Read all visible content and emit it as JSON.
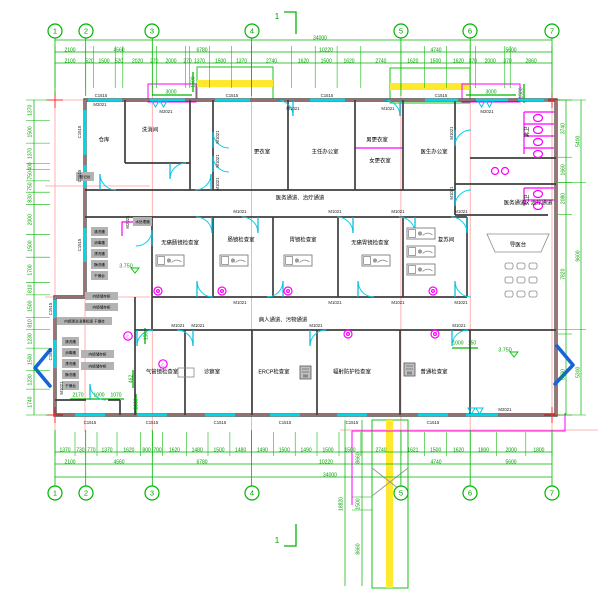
{
  "colors": {
    "dimension": "#00b400",
    "axis": "#ff9c9c",
    "wall": "#4f4f4f",
    "window": "#00d8e8",
    "magenta": "#ff00ff",
    "stair": "#ffef3d",
    "arrow": "#1565d8"
  },
  "grid_bubbles": {
    "top_y": 31,
    "bottom_y": 493,
    "top": [
      {
        "t": "1",
        "x": 55
      },
      {
        "t": "2",
        "x": 86
      },
      {
        "t": "3",
        "x": 152
      },
      {
        "t": "4",
        "x": 252
      },
      {
        "t": "5",
        "x": 401
      },
      {
        "t": "6",
        "x": 470
      },
      {
        "t": "7",
        "x": 552
      }
    ],
    "bottom": [
      {
        "t": "1",
        "x": 55
      },
      {
        "t": "2",
        "x": 86
      },
      {
        "t": "3",
        "x": 152
      },
      {
        "t": "4",
        "x": 252
      },
      {
        "t": "5",
        "x": 401
      },
      {
        "t": "6",
        "x": 470
      },
      {
        "t": "7",
        "x": 552
      }
    ]
  },
  "boundaries": {
    "grid_x": [
      55,
      85.7,
      152.3,
      251.5,
      400.9,
      470.2,
      552
    ],
    "top_x": [
      55,
      85.7,
      93.3,
      115.2,
      122.8,
      152.3,
      156.3,
      185.5,
      189.5,
      209.5,
      231.4,
      251.5,
      291.5,
      315.2,
      337.1,
      360.8,
      400.9,
      424.6,
      446.5,
      470.2,
      475.6,
      504.8,
      510.2,
      552
    ],
    "bottom_x": [
      55,
      75,
      85.7,
      97,
      117,
      140.7,
      152.4,
      162.6,
      186.3,
      208,
      229.9,
      251.5,
      273.3,
      295.2,
      317,
      339,
      360.9,
      401,
      424.7,
      446.6,
      470.3,
      496.6,
      525.8,
      552
    ],
    "left_y": [
      100,
      120.6,
      143.1,
      163.6,
      169.6,
      180.9,
      192.2,
      204.7,
      234.7,
      257.2,
      282.7,
      294.9,
      317.4,
      329.6,
      348.1,
      370.6,
      389.1,
      415
    ],
    "right_inner_y": [
      100,
      157.2,
      182.6,
      214.4,
      334,
      415
    ],
    "right_outer_y": [
      100,
      182.6,
      329.4,
      415
    ]
  },
  "labels": {
    "dims": [
      {
        "t": "34000",
        "x": 320,
        "y": 38
      },
      {
        "t": "2100",
        "x": 70,
        "y": 50
      },
      {
        "t": "4560",
        "x": 119,
        "y": 50
      },
      {
        "t": "6780",
        "x": 202,
        "y": 50
      },
      {
        "t": "10220",
        "x": 326,
        "y": 50
      },
      {
        "t": "4740",
        "x": 436,
        "y": 50
      },
      {
        "t": "5600",
        "x": 511,
        "y": 50
      },
      {
        "t": "2100",
        "x": 70,
        "y": 61
      },
      {
        "t": "520",
        "x": 89.5,
        "y": 61
      },
      {
        "t": "1500",
        "x": 104,
        "y": 61
      },
      {
        "t": "520",
        "x": 119,
        "y": 61
      },
      {
        "t": "2020",
        "x": 137.6,
        "y": 61
      },
      {
        "t": "270",
        "x": 154.3,
        "y": 61
      },
      {
        "t": "2000",
        "x": 171,
        "y": 61
      },
      {
        "t": "270",
        "x": 187.5,
        "y": 61
      },
      {
        "t": "1370",
        "x": 199.5,
        "y": 61
      },
      {
        "t": "1500",
        "x": 220.5,
        "y": 61
      },
      {
        "t": "1370",
        "x": 241.5,
        "y": 61
      },
      {
        "t": "2740",
        "x": 271.5,
        "y": 61
      },
      {
        "t": "1620",
        "x": 303.4,
        "y": 61
      },
      {
        "t": "1500",
        "x": 326.2,
        "y": 61
      },
      {
        "t": "1620",
        "x": 349,
        "y": 61
      },
      {
        "t": "2740",
        "x": 380.9,
        "y": 61
      },
      {
        "t": "1620",
        "x": 412.8,
        "y": 61
      },
      {
        "t": "1500",
        "x": 435.6,
        "y": 61
      },
      {
        "t": "1620",
        "x": 458.4,
        "y": 61
      },
      {
        "t": "370",
        "x": 472.9,
        "y": 61
      },
      {
        "t": "2000",
        "x": 490.2,
        "y": 61
      },
      {
        "t": "370",
        "x": 507.5,
        "y": 61
      },
      {
        "t": "2860",
        "x": 531.1,
        "y": 61
      },
      {
        "t": "1370",
        "x": 65,
        "y": 450
      },
      {
        "t": "730",
        "x": 80.4,
        "y": 450
      },
      {
        "t": "770",
        "x": 91.4,
        "y": 450
      },
      {
        "t": "1370",
        "x": 107,
        "y": 450
      },
      {
        "t": "1620",
        "x": 128.9,
        "y": 450
      },
      {
        "t": "800",
        "x": 146.6,
        "y": 450
      },
      {
        "t": "700",
        "x": 157.5,
        "y": 450
      },
      {
        "t": "1620",
        "x": 174.5,
        "y": 450
      },
      {
        "t": "1480",
        "x": 197.2,
        "y": 450
      },
      {
        "t": "1500",
        "x": 219,
        "y": 450
      },
      {
        "t": "1480",
        "x": 240.7,
        "y": 450
      },
      {
        "t": "1490",
        "x": 262.4,
        "y": 450
      },
      {
        "t": "1500",
        "x": 284.3,
        "y": 450
      },
      {
        "t": "1490",
        "x": 306.1,
        "y": 450
      },
      {
        "t": "1500",
        "x": 328,
        "y": 450
      },
      {
        "t": "1500",
        "x": 350,
        "y": 450
      },
      {
        "t": "2740",
        "x": 381,
        "y": 450
      },
      {
        "t": "1621",
        "x": 412.9,
        "y": 450
      },
      {
        "t": "1500",
        "x": 435.7,
        "y": 450
      },
      {
        "t": "1620",
        "x": 458.5,
        "y": 450
      },
      {
        "t": "1800",
        "x": 483.5,
        "y": 450
      },
      {
        "t": "2000",
        "x": 511.2,
        "y": 450
      },
      {
        "t": "1800",
        "x": 538.9,
        "y": 450
      },
      {
        "t": "2100",
        "x": 70,
        "y": 462
      },
      {
        "t": "4560",
        "x": 119,
        "y": 462
      },
      {
        "t": "6780",
        "x": 202,
        "y": 462
      },
      {
        "t": "10220",
        "x": 326,
        "y": 462
      },
      {
        "t": "4740",
        "x": 436,
        "y": 462
      },
      {
        "t": "5600",
        "x": 511,
        "y": 462
      },
      {
        "t": "34000",
        "x": 330,
        "y": 475
      },
      {
        "t": "1370",
        "x": 30,
        "y": 110.3,
        "r": -90
      },
      {
        "t": "1500",
        "x": 30,
        "y": 131.9,
        "r": -90
      },
      {
        "t": "1370",
        "x": 30,
        "y": 153.4,
        "r": -90
      },
      {
        "t": "400",
        "x": 30,
        "y": 166.6,
        "r": -90
      },
      {
        "t": "750",
        "x": 30,
        "y": 175.3,
        "r": -90
      },
      {
        "t": "750",
        "x": 30,
        "y": 186.6,
        "r": -90
      },
      {
        "t": "830",
        "x": 30,
        "y": 198.5,
        "r": -90
      },
      {
        "t": "2000",
        "x": 30,
        "y": 219.7,
        "r": -90
      },
      {
        "t": "1500",
        "x": 30,
        "y": 246,
        "r": -90
      },
      {
        "t": "1700",
        "x": 30,
        "y": 270,
        "r": -90
      },
      {
        "t": "810",
        "x": 30,
        "y": 288.8,
        "r": -90
      },
      {
        "t": "1500",
        "x": 30,
        "y": 306.2,
        "r": -90
      },
      {
        "t": "810",
        "x": 30,
        "y": 323.5,
        "r": -90
      },
      {
        "t": "1230",
        "x": 30,
        "y": 338.9,
        "r": -90
      },
      {
        "t": "1500",
        "x": 30,
        "y": 359.4,
        "r": -90
      },
      {
        "t": "1230",
        "x": 30,
        "y": 379.9,
        "r": -90
      },
      {
        "t": "1740",
        "x": 30,
        "y": 402.1,
        "r": -90
      },
      {
        "t": "3740",
        "x": 563,
        "y": 128.6,
        "r": -90
      },
      {
        "t": "1660",
        "x": 563,
        "y": 169.9,
        "r": -90
      },
      {
        "t": "2080",
        "x": 563,
        "y": 198.5,
        "r": -90
      },
      {
        "t": "7820",
        "x": 563,
        "y": 274.2,
        "r": -90
      },
      {
        "t": "5700",
        "x": 563,
        "y": 374.5,
        "r": -90
      },
      {
        "t": "5400",
        "x": 578,
        "y": 141.3,
        "r": -90
      },
      {
        "t": "9600",
        "x": 578,
        "y": 256,
        "r": -90
      },
      {
        "t": "5300",
        "x": 578,
        "y": 372.3,
        "r": -90
      },
      {
        "t": "8660",
        "x": 358,
        "y": 458,
        "r": -90
      },
      {
        "t": "1500",
        "x": 358,
        "y": 504,
        "r": -90
      },
      {
        "t": "8660",
        "x": 358,
        "y": 549,
        "r": -90
      },
      {
        "t": "18820",
        "x": 341,
        "y": 504,
        "r": -90
      },
      {
        "t": "3000",
        "x": 171,
        "y": 92
      },
      {
        "t": "3000",
        "x": 491,
        "y": 92
      },
      {
        "t": "1500",
        "x": 521,
        "y": 93,
        "r": -90
      },
      {
        "t": "1500",
        "x": 193,
        "y": 82,
        "r": -90
      },
      {
        "t": "150",
        "x": 146,
        "y": 336,
        "r": -90
      },
      {
        "t": "1000",
        "x": 458,
        "y": 343
      },
      {
        "t": "150",
        "x": 472,
        "y": 343
      },
      {
        "t": "2170",
        "x": 78,
        "y": 395
      },
      {
        "t": "1000",
        "x": 99,
        "y": 395
      },
      {
        "t": "1070",
        "x": 116,
        "y": 395
      },
      {
        "t": "462",
        "x": 131,
        "y": 379,
        "r": -90
      },
      {
        "t": "1000",
        "x": 136,
        "y": 404,
        "r": -90
      }
    ],
    "greens": [
      {
        "t": "3.750",
        "x": 126,
        "y": 266
      },
      {
        "t": "3.750",
        "x": 505,
        "y": 350
      }
    ],
    "sections": [
      {
        "t": "1",
        "x": 277,
        "y": 17
      },
      {
        "t": "1",
        "x": 277,
        "y": 541
      }
    ],
    "tags": [
      {
        "t": "C1515",
        "x": 101,
        "y": 96
      },
      {
        "t": "C1515",
        "x": 232,
        "y": 96
      },
      {
        "t": "C1515",
        "x": 327,
        "y": 96
      },
      {
        "t": "C1515",
        "x": 441,
        "y": 96
      },
      {
        "t": "C1515",
        "x": 90,
        "y": 423
      },
      {
        "t": "C1515",
        "x": 152,
        "y": 423
      },
      {
        "t": "C1515",
        "x": 220,
        "y": 423
      },
      {
        "t": "C1515",
        "x": 285,
        "y": 423
      },
      {
        "t": "C1515",
        "x": 352,
        "y": 423
      },
      {
        "t": "C1515",
        "x": 433,
        "y": 423
      },
      {
        "t": "C1515",
        "x": 80,
        "y": 132,
        "r": -90
      },
      {
        "t": "C1515",
        "x": 80,
        "y": 176,
        "r": -90
      },
      {
        "t": "C1515",
        "x": 80,
        "y": 245,
        "r": -90
      },
      {
        "t": "C1515",
        "x": 51,
        "y": 309,
        "r": -90
      },
      {
        "t": "C1515",
        "x": 51,
        "y": 354,
        "r": -90
      },
      {
        "t": "M1021",
        "x": 240,
        "y": 212
      },
      {
        "t": "M1021",
        "x": 335,
        "y": 212
      },
      {
        "t": "M1021",
        "x": 398,
        "y": 212
      },
      {
        "t": "M1021",
        "x": 461,
        "y": 212
      },
      {
        "t": "M1021",
        "x": 240,
        "y": 303
      },
      {
        "t": "M1021",
        "x": 335,
        "y": 303
      },
      {
        "t": "M1021",
        "x": 398,
        "y": 303
      },
      {
        "t": "M1021",
        "x": 461,
        "y": 303
      },
      {
        "t": "M1021",
        "x": 178,
        "y": 326
      },
      {
        "t": "M1021",
        "x": 198,
        "y": 326
      },
      {
        "t": "M1021",
        "x": 316,
        "y": 326
      },
      {
        "t": "M1021",
        "x": 459,
        "y": 326
      },
      {
        "t": "M1021",
        "x": 218,
        "y": 137,
        "r": -90
      },
      {
        "t": "M1021",
        "x": 218,
        "y": 161,
        "r": -90
      },
      {
        "t": "M1021",
        "x": 218,
        "y": 184,
        "r": -90
      },
      {
        "t": "M1021",
        "x": 452,
        "y": 133,
        "r": -90
      },
      {
        "t": "M1021",
        "x": 452,
        "y": 193,
        "r": -90
      },
      {
        "t": "M1021",
        "x": 62,
        "y": 388,
        "r": -90
      },
      {
        "t": "M1021",
        "x": 293,
        "y": 109
      },
      {
        "t": "M1021",
        "x": 388,
        "y": 109
      },
      {
        "t": "M2021",
        "x": 166,
        "y": 112
      },
      {
        "t": "M2021",
        "x": 487,
        "y": 112
      },
      {
        "t": "M2021",
        "x": 505,
        "y": 410
      },
      {
        "t": "M2021",
        "x": 128,
        "y": 222,
        "r": -90
      },
      {
        "t": "M2021",
        "x": 100,
        "y": 105
      }
    ],
    "rooms": [
      {
        "t": "仓库",
        "x": 104,
        "y": 140
      },
      {
        "t": "洗消间",
        "x": 150,
        "y": 130
      },
      {
        "t": "更衣室",
        "x": 262,
        "y": 152
      },
      {
        "t": "主任办公室",
        "x": 325,
        "y": 152
      },
      {
        "t": "男更衣室",
        "x": 377,
        "y": 140
      },
      {
        "t": "女更衣室",
        "x": 380,
        "y": 161
      },
      {
        "t": "医生办公室",
        "x": 434,
        "y": 152
      },
      {
        "t": "男卫",
        "x": 527,
        "y": 132,
        "r": -90
      },
      {
        "t": "女卫",
        "x": 527,
        "y": 200,
        "r": -90
      },
      {
        "t": "医务通道、治疗通道",
        "x": 300,
        "y": 198
      },
      {
        "t": "医务通道、治疗通道",
        "x": 528,
        "y": 203
      },
      {
        "t": "无痛肠镜检查室",
        "x": 180,
        "y": 243
      },
      {
        "t": "肠镜检查室",
        "x": 241,
        "y": 240
      },
      {
        "t": "胃镜检查室",
        "x": 303,
        "y": 240
      },
      {
        "t": "无痛胃镜检查室",
        "x": 370,
        "y": 243
      },
      {
        "t": "复苏间",
        "x": 446,
        "y": 240
      },
      {
        "t": "导医台",
        "x": 518,
        "y": 245
      },
      {
        "t": "病人通道、污物通道",
        "x": 283,
        "y": 320
      },
      {
        "t": "气管镜检查室",
        "x": 162,
        "y": 372
      },
      {
        "t": "诊察室",
        "x": 212,
        "y": 372
      },
      {
        "t": "ERCP检查室",
        "x": 274,
        "y": 372
      },
      {
        "t": "辐射防护检查室",
        "x": 352,
        "y": 372
      },
      {
        "t": "普通检查室",
        "x": 434,
        "y": 372
      }
    ],
    "mag": [
      {
        "t": "C",
        "x": 163,
        "y": 365.5
      },
      {
        "t": "C",
        "x": 128,
        "y": 337.5
      }
    ],
    "notes": [
      {
        "t": "清洗槽",
        "x": 91,
        "y": 227,
        "w": 17,
        "h": 9
      },
      {
        "t": "消毒槽",
        "x": 91,
        "y": 238,
        "w": 17,
        "h": 9
      },
      {
        "t": "漂洗槽",
        "x": 91,
        "y": 249,
        "w": 17,
        "h": 9
      },
      {
        "t": "酶洗槽",
        "x": 91,
        "y": 260,
        "w": 17,
        "h": 9
      },
      {
        "t": "干燥台",
        "x": 91,
        "y": 271,
        "w": 17,
        "h": 9
      },
      {
        "t": "内镜储存柜",
        "x": 85,
        "y": 292,
        "w": 33,
        "h": 8
      },
      {
        "t": "内镜储存柜",
        "x": 85,
        "y": 303,
        "w": 33,
        "h": 8
      },
      {
        "t": "内镜清洗消毒机组 干燥台",
        "x": 57,
        "y": 317,
        "w": 55,
        "h": 8
      },
      {
        "t": "清洗槽",
        "x": 62,
        "y": 337,
        "w": 17,
        "h": 9
      },
      {
        "t": "消毒槽",
        "x": 62,
        "y": 348,
        "w": 17,
        "h": 9
      },
      {
        "t": "漂洗槽",
        "x": 62,
        "y": 359,
        "w": 17,
        "h": 9
      },
      {
        "t": "酶洗槽",
        "x": 62,
        "y": 370,
        "w": 17,
        "h": 9
      },
      {
        "t": "干燥台",
        "x": 62,
        "y": 381,
        "w": 17,
        "h": 9
      },
      {
        "t": "内镜储存柜",
        "x": 81,
        "y": 350,
        "w": 33,
        "h": 8
      },
      {
        "t": "内镜储存柜",
        "x": 81,
        "y": 362,
        "w": 33,
        "h": 8
      },
      {
        "t": "登记台",
        "x": 76,
        "y": 172,
        "w": 18,
        "h": 9
      },
      {
        "t": "水处理器",
        "x": 133,
        "y": 217,
        "w": 19,
        "h": 9
      }
    ]
  }
}
